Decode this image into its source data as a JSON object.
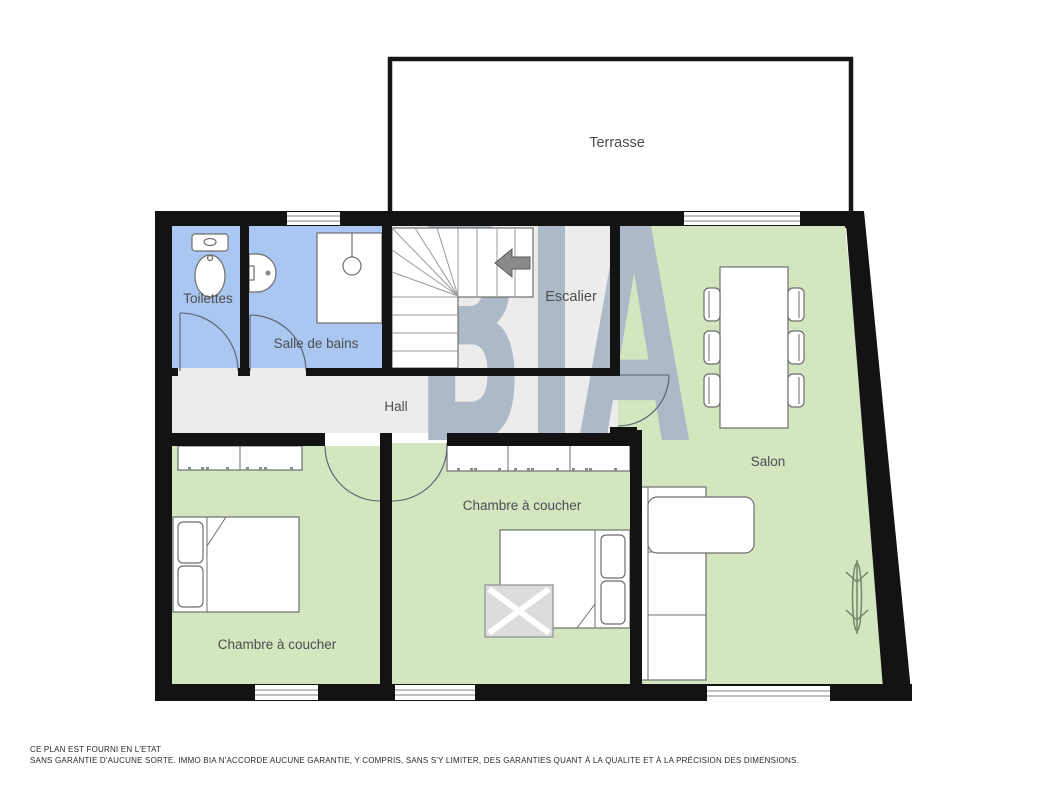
{
  "rooms": {
    "terrasse": "Terrasse",
    "toilettes": "Toilettes",
    "salle_de_bains": "Salle de bains",
    "escalier": "Escalier",
    "hall": "Hall",
    "salon": "Salon",
    "chambre1": "Chambre à coucher",
    "chambre2": "Chambre à coucher"
  },
  "watermark": {
    "text": "BIA"
  },
  "disclaimer": {
    "line1": "CE PLAN EST FOURNI EN L'ETAT",
    "line2": "SANS GARANTIE D'AUCUNE SORTE. IMMO BIA N'ACCORDE AUCUNE GARANTIE, Y COMPRIS, SANS S'Y LIMITER, DES GARANTIES QUANT À LA QUALITE ET À LA PRÉCISION DES DIMENSIONS."
  },
  "colors": {
    "wall": "#131313",
    "room_blue": "#a9c7f1",
    "room_green": "#d3e6c0",
    "room_gray": "#ececec",
    "watermark": "#aeb9c8",
    "label_text": "#4d4d4d",
    "furniture_stroke": "#6e6e6e"
  }
}
